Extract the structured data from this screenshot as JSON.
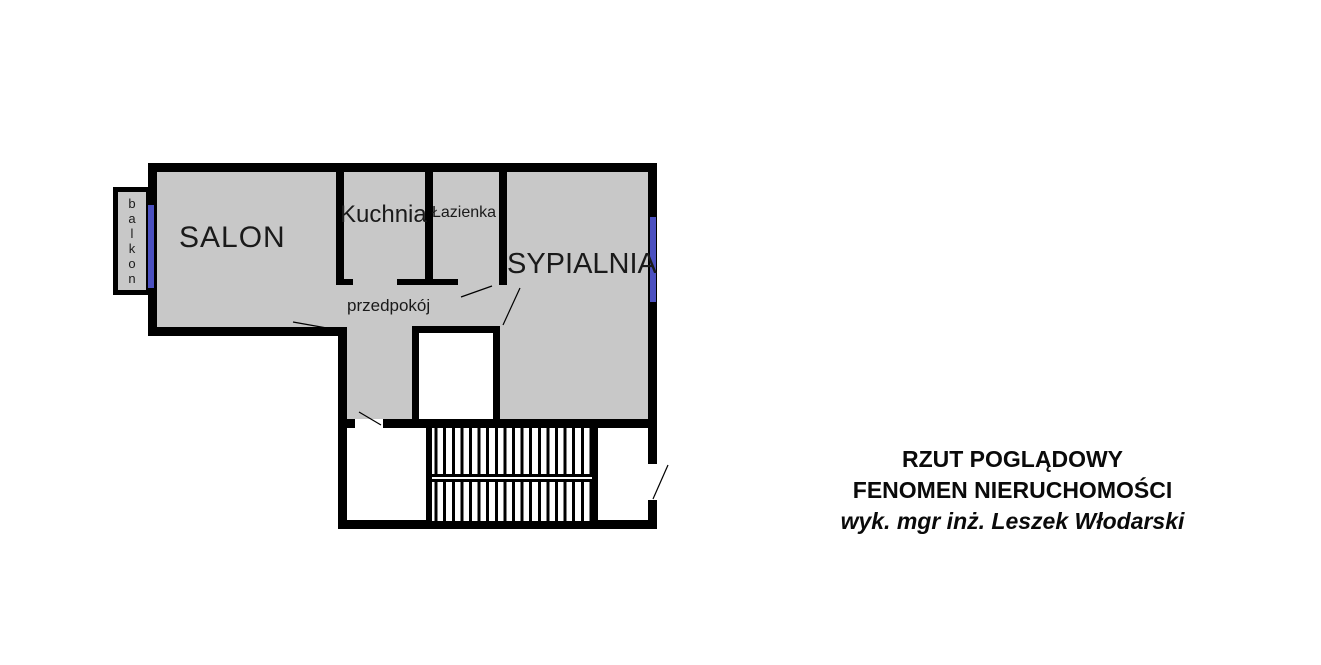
{
  "plan": {
    "rooms": {
      "salon": "SALON",
      "kuchnia": "Kuchnia",
      "lazienka": "Łazienka",
      "sypialnia": "SYPIALNIA",
      "przedpokoj": "przedpokój",
      "balkon": "balkon"
    }
  },
  "title_block": {
    "line1": "RZUT POGLĄDOWY",
    "line2": "FENOMEN NIERUCHOMOŚCI",
    "line3": "wyk. mgr inż. Leszek Włodarski"
  },
  "colors": {
    "wall": "#000000",
    "room_fill": "#c8c8c8",
    "window_accent": "#4b50c0",
    "background": "#ffffff"
  }
}
